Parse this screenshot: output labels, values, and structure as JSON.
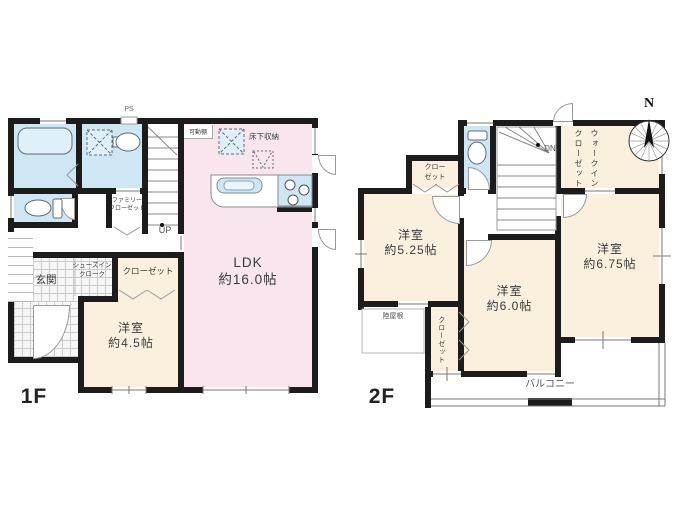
{
  "floor1": {
    "floor_label": "1F",
    "ps": "PS",
    "movable_shelf": "可動棚",
    "underfloor_storage": "床下収納",
    "up": "UP",
    "entrance": "玄関",
    "shoes_in_closet": "シューズイン\nクローク",
    "family_closet": "ファミリー\nクローゼット",
    "closet": "クローゼット",
    "rooms": {
      "ldk": {
        "name": "LDK",
        "size": "約16.0帖"
      },
      "bedroom_45": {
        "name": "洋室",
        "size": "約4.5帖"
      }
    }
  },
  "floor2": {
    "floor_label": "2F",
    "dn": "DN",
    "closet_upper": "クロー\nゼット",
    "walk_in_closet": "ウォークイン\nクローゼット",
    "closet_lower": "クローゼット",
    "flat_roof": "陸屋根",
    "balcony": "バルコニー",
    "rooms": {
      "bedroom_525": {
        "name": "洋室",
        "size": "約5.25帖"
      },
      "bedroom_60": {
        "name": "洋室",
        "size": "約6.0帖"
      },
      "bedroom_675": {
        "name": "洋室",
        "size": "約6.75帖"
      }
    }
  },
  "compass": {
    "north_label": "N"
  },
  "colors": {
    "wall": "#1c1c1c",
    "wet": "#cfe6f5",
    "wetlight": "#dff0fa",
    "ldk": "#f9e5ee",
    "room": "#faf0dd",
    "line": "#8a8a8a",
    "tileline": "#cccccc",
    "text": "#3a3a3a"
  }
}
